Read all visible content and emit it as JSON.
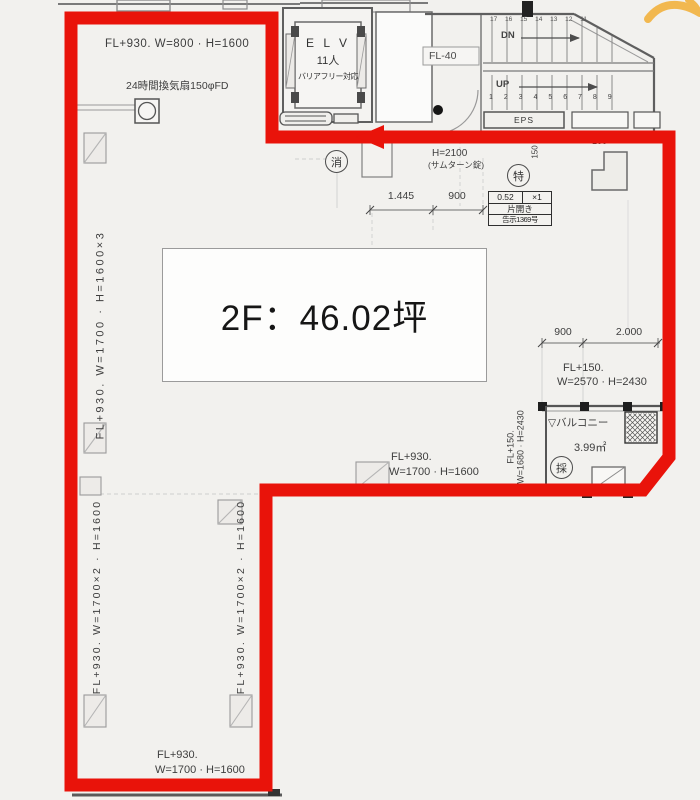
{
  "floor_label": "2F：46.02坪",
  "colors": {
    "outline": "#e9130a",
    "watermark": "#f2b23e"
  },
  "elevator": {
    "name": "E L V",
    "capacity": "11人",
    "note": "バリアフリー対応"
  },
  "stairs": {
    "down": "DN",
    "up": "UP",
    "upper_steps": "17 16 15 14 13 12 11",
    "lower_steps": "1 2 3 4 5 6 7 8 9",
    "level": "FL-40",
    "eps": "EPS"
  },
  "marks": {
    "fire": "消",
    "special": "特",
    "daylight": "採"
  },
  "entry": {
    "height": "H=2100",
    "lock": "(サムターン錠)",
    "dim_a": "1.445",
    "dim_b": "900",
    "spec_value": "0.52",
    "spec_count": "×1",
    "spec_type": "片開き",
    "spec_code": "告示1369号"
  },
  "vent": "24時間換気扇150φFD",
  "windows": {
    "top_left": "FL+930. W=800 · H=1600",
    "left_upper_v": "FL+930. W=1700 · H=1600×3",
    "left_lower_v": "FL+930. W=1700×2 · H=1600",
    "mid_lower_v": "FL+930. W=1700×2 · H=1600",
    "mid_l1": "FL+930.",
    "mid_l2": "W=1700 · H=1600",
    "bottom_l1": "FL+930.",
    "bottom_l2": "W=1700 · H=1600",
    "right_l1": "FL+150.",
    "right_l2": "W=2570 · H=2430",
    "balcony_l1": "FL+150.",
    "balcony_l2": "W=1680 · H=2430"
  },
  "balcony": {
    "marker": "▽",
    "name": "バルコニー",
    "area": "3.99㎡"
  },
  "dims": {
    "right_a": "900",
    "right_b": "2.000",
    "v150": "150",
    "h100": "100"
  }
}
